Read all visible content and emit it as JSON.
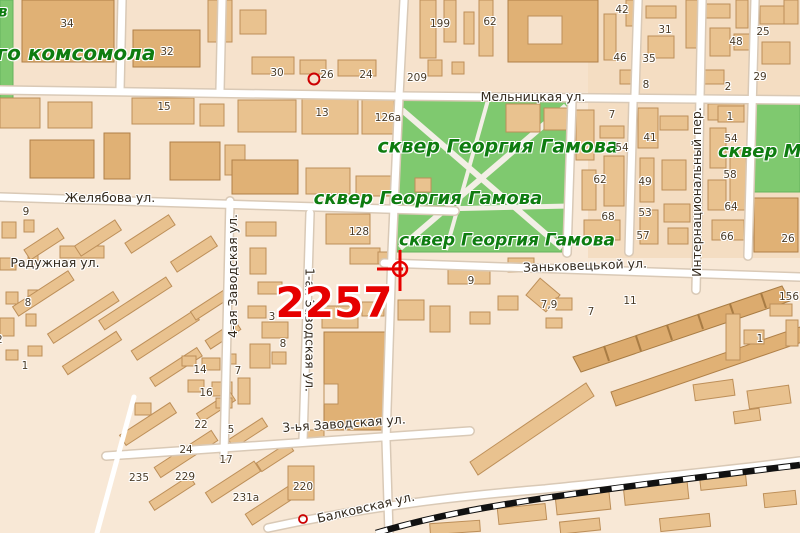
{
  "title": "City map fragment with marked point 2257",
  "colors": {
    "background": "#f8e8d6",
    "block_tint_top": "#f6e2cc",
    "block_tint_right": "#f4ddc2",
    "park_green": "#7fc96f",
    "building_fill": "#e9c28f",
    "building_dark": "#e0b175",
    "road_fill": "#ffffff",
    "road_casing": "#d9c9b6",
    "railway": "#000000",
    "highlight_red": "#e60000",
    "park_label_green": "#0e7c10",
    "street_label": "#33291c",
    "number_label": "#4a3b27"
  },
  "map": {
    "highlight_number": "2257",
    "labels": [
      {
        "t": "в",
        "x": -2,
        "y": 12,
        "c": "park",
        "f": 15,
        "a": "start",
        "n": "park-label-cut"
      },
      {
        "t": "го комсомола",
        "x": 76,
        "y": 53,
        "c": "park",
        "f": 20,
        "n": "park-label-komsomola"
      },
      {
        "t": "сквер Георгия Гамова",
        "x": 498,
        "y": 147,
        "c": "park",
        "f": 19,
        "n": "park-label-gamova-1"
      },
      {
        "t": "сквер Георгия Гамова",
        "x": 428,
        "y": 199,
        "c": "park",
        "f": 18,
        "n": "park-label-gamova-2"
      },
      {
        "t": "сквер Георгия Гамова",
        "x": 507,
        "y": 241,
        "c": "park",
        "f": 17,
        "n": "park-label-gamova-3"
      },
      {
        "t": "сквер М",
        "x": 718,
        "y": 152,
        "c": "park",
        "f": 18,
        "a": "start",
        "n": "park-label-m-cut"
      },
      {
        "t": "Мельницкая ул.",
        "x": 533,
        "y": 97,
        "c": "street"
      },
      {
        "t": "Желябова ул.",
        "x": 110,
        "y": 198,
        "c": "street"
      },
      {
        "t": "Радужная ул.",
        "x": 55,
        "y": 263,
        "c": "street"
      },
      {
        "t": "Заньковецькой ул.",
        "x": 585,
        "y": 266,
        "c": "street",
        "r": -2
      },
      {
        "t": "3-ья Заводская ул.",
        "x": 344,
        "y": 424,
        "c": "street",
        "r": -4
      },
      {
        "t": "Балковская ул.",
        "x": 366,
        "y": 508,
        "c": "street",
        "r": -13
      },
      {
        "t": "4-ая Заводская ул.",
        "x": 233,
        "y": 276,
        "c": "street",
        "r": -90
      },
      {
        "t": "1-ая Заводская ул.",
        "x": 309,
        "y": 330,
        "c": "street",
        "r": 90
      },
      {
        "t": "Интернациональный пер.",
        "x": 697,
        "y": 192,
        "c": "street",
        "r": -90
      },
      {
        "t": "34",
        "x": 67,
        "y": 24,
        "c": "num"
      },
      {
        "t": "32",
        "x": 167,
        "y": 52,
        "c": "num"
      },
      {
        "t": "30",
        "x": 277,
        "y": 73,
        "c": "num"
      },
      {
        "t": "26",
        "x": 327,
        "y": 75,
        "c": "num"
      },
      {
        "t": "24",
        "x": 366,
        "y": 75,
        "c": "num"
      },
      {
        "t": "199",
        "x": 440,
        "y": 24,
        "c": "num"
      },
      {
        "t": "62",
        "x": 490,
        "y": 22,
        "c": "num"
      },
      {
        "t": "209",
        "x": 417,
        "y": 78,
        "c": "num"
      },
      {
        "t": "42",
        "x": 622,
        "y": 10,
        "c": "num"
      },
      {
        "t": "31",
        "x": 665,
        "y": 30,
        "c": "num"
      },
      {
        "t": "48",
        "x": 736,
        "y": 42,
        "c": "num"
      },
      {
        "t": "25",
        "x": 763,
        "y": 32,
        "c": "num"
      },
      {
        "t": "46",
        "x": 620,
        "y": 58,
        "c": "num"
      },
      {
        "t": "35",
        "x": 649,
        "y": 59,
        "c": "num"
      },
      {
        "t": "8",
        "x": 646,
        "y": 85,
        "c": "num"
      },
      {
        "t": "2",
        "x": 728,
        "y": 87,
        "c": "num"
      },
      {
        "t": "29",
        "x": 760,
        "y": 77,
        "c": "num"
      },
      {
        "t": "15",
        "x": 164,
        "y": 107,
        "c": "num"
      },
      {
        "t": "13",
        "x": 322,
        "y": 113,
        "c": "num"
      },
      {
        "t": "126а",
        "x": 388,
        "y": 118,
        "c": "num"
      },
      {
        "t": "7",
        "x": 612,
        "y": 115,
        "c": "num"
      },
      {
        "t": "1",
        "x": 730,
        "y": 117,
        "c": "num"
      },
      {
        "t": "54",
        "x": 622,
        "y": 148,
        "c": "num"
      },
      {
        "t": "41",
        "x": 650,
        "y": 138,
        "c": "num"
      },
      {
        "t": "54",
        "x": 731,
        "y": 139,
        "c": "num"
      },
      {
        "t": "58",
        "x": 730,
        "y": 175,
        "c": "num"
      },
      {
        "t": "62",
        "x": 600,
        "y": 180,
        "c": "num"
      },
      {
        "t": "49",
        "x": 645,
        "y": 182,
        "c": "num"
      },
      {
        "t": "68",
        "x": 608,
        "y": 217,
        "c": "num"
      },
      {
        "t": "53",
        "x": 645,
        "y": 213,
        "c": "num"
      },
      {
        "t": "64",
        "x": 731,
        "y": 207,
        "c": "num"
      },
      {
        "t": "57",
        "x": 643,
        "y": 236,
        "c": "num"
      },
      {
        "t": "66",
        "x": 727,
        "y": 237,
        "c": "num"
      },
      {
        "t": "26",
        "x": 788,
        "y": 239,
        "c": "num"
      },
      {
        "t": "128",
        "x": 359,
        "y": 232,
        "c": "num"
      },
      {
        "t": "9",
        "x": 26,
        "y": 212,
        "c": "num"
      },
      {
        "t": "9",
        "x": 471,
        "y": 281,
        "c": "num"
      },
      {
        "t": "7,9",
        "x": 549,
        "y": 305,
        "c": "num"
      },
      {
        "t": "7",
        "x": 591,
        "y": 312,
        "c": "num"
      },
      {
        "t": "11",
        "x": 630,
        "y": 301,
        "c": "num"
      },
      {
        "t": "156",
        "x": 789,
        "y": 297,
        "c": "num"
      },
      {
        "t": "1",
        "x": 760,
        "y": 339,
        "c": "num"
      },
      {
        "t": "3",
        "x": 272,
        "y": 317,
        "c": "num"
      },
      {
        "t": "8",
        "x": 283,
        "y": 344,
        "c": "num"
      },
      {
        "t": "8",
        "x": 28,
        "y": 303,
        "c": "num"
      },
      {
        "t": "2",
        "x": -4,
        "y": 340,
        "c": "num",
        "a": "start"
      },
      {
        "t": "1",
        "x": 25,
        "y": 366,
        "c": "num"
      },
      {
        "t": "14",
        "x": 200,
        "y": 370,
        "c": "num"
      },
      {
        "t": "7",
        "x": 238,
        "y": 371,
        "c": "num"
      },
      {
        "t": "16",
        "x": 206,
        "y": 393,
        "c": "num"
      },
      {
        "t": "22",
        "x": 201,
        "y": 425,
        "c": "num"
      },
      {
        "t": "5",
        "x": 231,
        "y": 430,
        "c": "num"
      },
      {
        "t": "24",
        "x": 186,
        "y": 450,
        "c": "num"
      },
      {
        "t": "17",
        "x": 226,
        "y": 460,
        "c": "num"
      },
      {
        "t": "235",
        "x": 139,
        "y": 478,
        "c": "num"
      },
      {
        "t": "229",
        "x": 185,
        "y": 477,
        "c": "num"
      },
      {
        "t": "220",
        "x": 303,
        "y": 487,
        "c": "num"
      },
      {
        "t": "231а",
        "x": 246,
        "y": 498,
        "c": "num"
      },
      {
        "t": "2257",
        "x": 334,
        "y": 303,
        "c": "hl",
        "n": "highlight-number"
      }
    ]
  }
}
